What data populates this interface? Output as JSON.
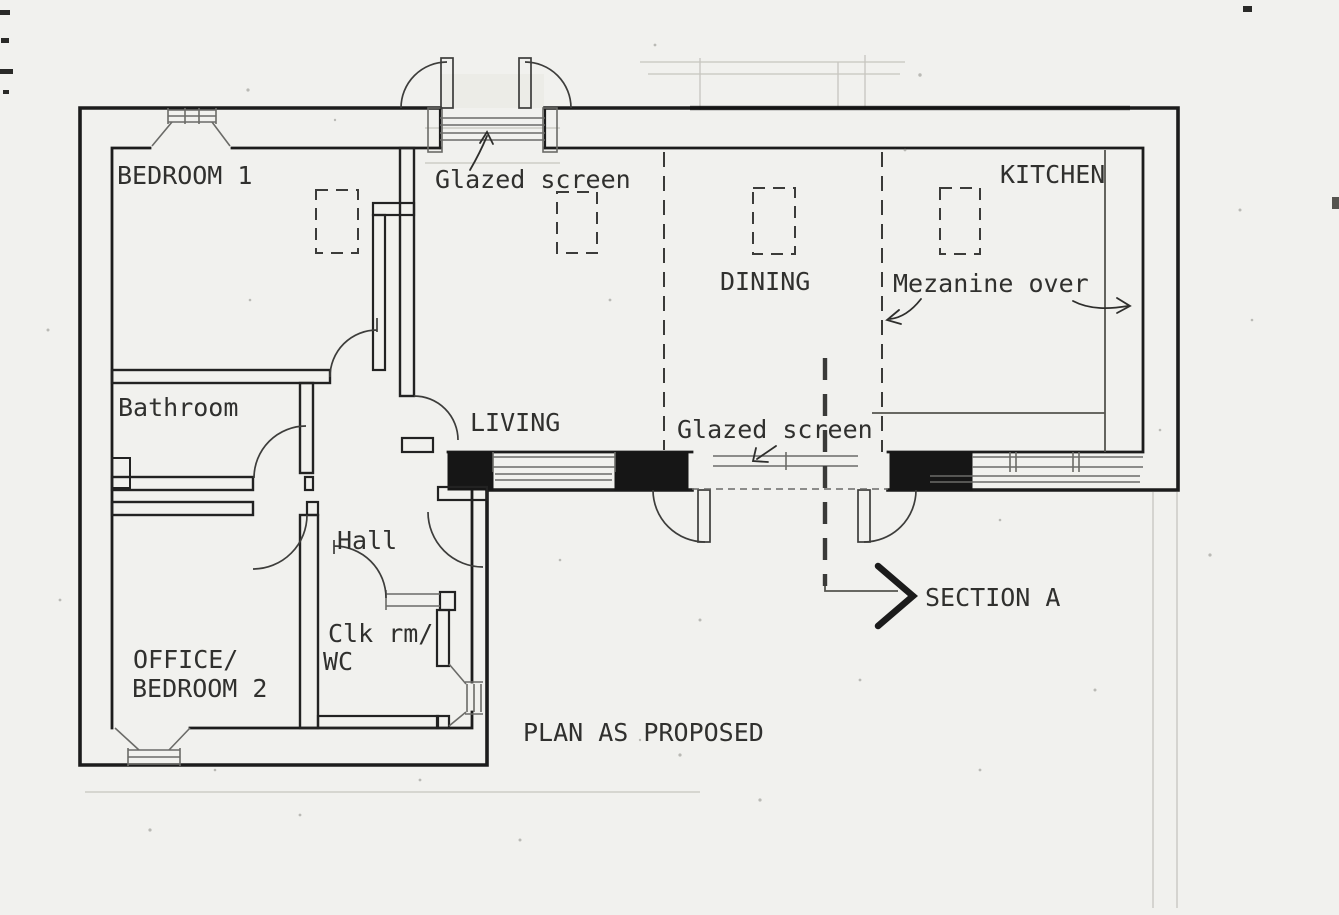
{
  "drawing": {
    "title": "PLAN AS PROPOSED",
    "rooms": {
      "bedroom1": "BEDROOM 1",
      "bathroom": "Bathroom",
      "office_line1": "OFFICE/",
      "office_line2": "BEDROOM 2",
      "hall": "Hall",
      "cloakroom_line1": "Clk rm/",
      "cloakroom_line2": "WC",
      "living": "LIVING",
      "dining": "DINING",
      "kitchen": "KITCHEN"
    },
    "annotations": {
      "glazed_screen_entrance": "Glazed screen",
      "glazed_screen_garden": "Glazed screen",
      "mezzanine": "Mezanine over",
      "section_marker": "SECTION A"
    },
    "colors": {
      "paper": "#f1f1ee",
      "wall_ink": "#1c1c1c",
      "thin_ink": "#55544f",
      "faint_ink": "#c6c5bf",
      "text_ink": "#30302e"
    }
  }
}
